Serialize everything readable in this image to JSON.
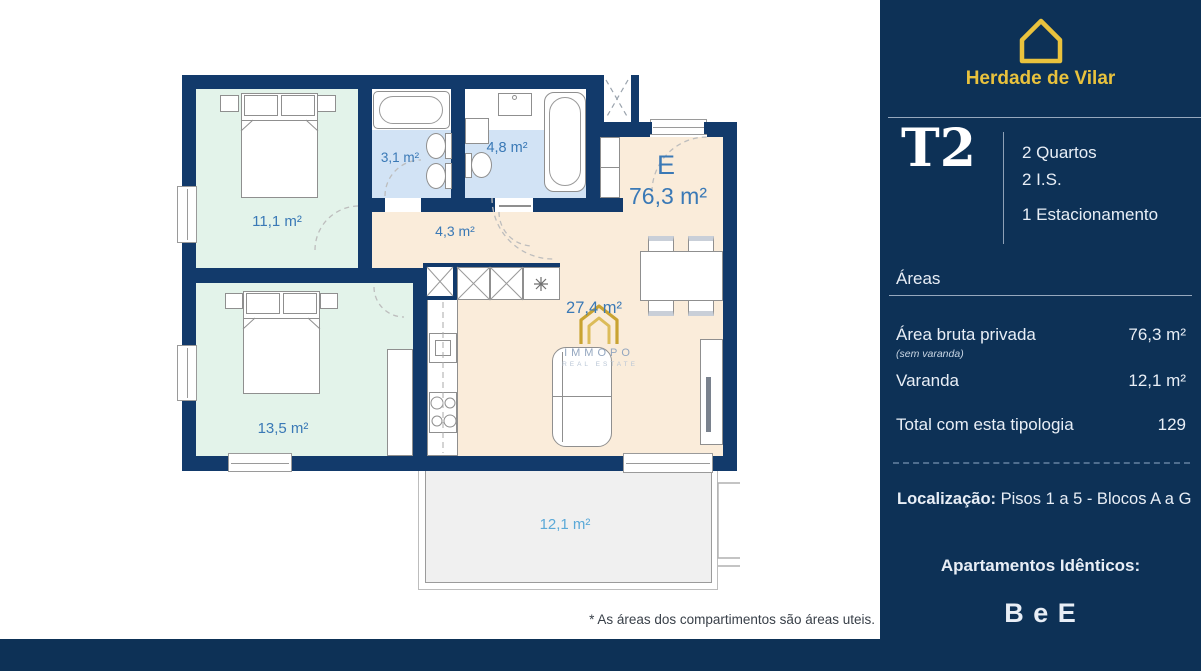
{
  "floorplan": {
    "unit_letter": "E",
    "unit_total_area": "76,3 m²",
    "rooms": [
      {
        "id": "bedroom-1",
        "area": "11,1 m²"
      },
      {
        "id": "bathroom-1",
        "area": "3,1 m²"
      },
      {
        "id": "bathroom-2",
        "area": "4,8 m²"
      },
      {
        "id": "hall",
        "area": "4,3 m²"
      },
      {
        "id": "living-kitchen",
        "area": "27,4 m²"
      },
      {
        "id": "bedroom-2",
        "area": "13,5 m²"
      },
      {
        "id": "balcony",
        "area": "12,1 m²"
      }
    ],
    "watermark": {
      "brand": "IMMOPO",
      "tagline": "REAL ESTATE"
    },
    "footnote": "* As áreas dos compartimentos são áreas uteis."
  },
  "sidebar": {
    "project_name": "Herdade de Vilar",
    "typology": "T2",
    "features": [
      "2 Quartos",
      "2 I.S.",
      "1 Estacionamento"
    ],
    "areas": {
      "heading": "Áreas",
      "rows": [
        {
          "label": "Área bruta privada",
          "note": "(sem varanda)",
          "value": "76,3 m²"
        },
        {
          "label": "Varanda",
          "note": "",
          "value": "12,1 m²"
        },
        {
          "label": "Total com esta tipologia",
          "note": "",
          "value": "129"
        }
      ]
    },
    "location": {
      "label": "Localização:",
      "value": "Pisos 1 a 5 - Blocos A a G"
    },
    "identical": {
      "heading": "Apartamentos Idênticos:",
      "value": "B e E"
    }
  },
  "colors": {
    "sidebar_bg": "#0d3156",
    "wall_navy": "#123a6b",
    "accent_yellow": "#e9c23d",
    "room_mint": "#e3f3ea",
    "room_blue": "#d2e3f5",
    "room_beige": "#faecda",
    "balcony_gray": "#f0f0f0",
    "label_blue": "#3a79b6",
    "balcony_label_blue": "#5ba9d8"
  }
}
